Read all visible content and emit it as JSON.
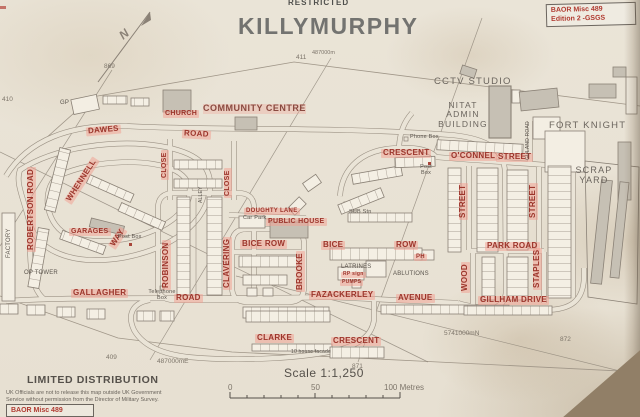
{
  "header": {
    "classification": "RESTRICTED",
    "title": "KILLYMURPHY"
  },
  "edition_box": {
    "line1": "BAOR Misc 489",
    "line2": "Edition 2 -GSGS"
  },
  "corner_box": {
    "text": "BAOR Misc 489"
  },
  "distribution": {
    "heading": "LIMITED DISTRIBUTION",
    "line1": "UK Officials are not to release this map outside UK Government",
    "line2": "Service without permission from the Director of Military Survey."
  },
  "scale": {
    "label": "Scale 1:1,250",
    "tick0": "0",
    "tick50": "50",
    "tick100": "100 Metres"
  },
  "grid": {
    "e869": "869",
    "n411": "411",
    "e870_top": "487000m",
    "n410": "410",
    "n409": "409",
    "e870_bottom": "487000mE",
    "e871": "871",
    "e872": "872",
    "n5741": "5741000mN"
  },
  "compass": {
    "label": "N"
  },
  "colors": {
    "red_label": "#9c352b",
    "highlight": "#f19d8f",
    "paper": "#eae4d7",
    "line": "#8a8176"
  },
  "labels": {
    "dawes": "DAWES",
    "dawes_road": "ROAD",
    "church": "CHURCH",
    "community_centre": "COMMUNITY CENTRE",
    "close_a": "CLOSE",
    "close_b": "CLOSE",
    "whennell": "WHENNELL",
    "robertson_road": "ROBERTSON ROAD",
    "garages": "GARAGES",
    "way": "WAY",
    "robinson": "ROBINSON",
    "clavering": "CLAVERING",
    "bice_row_a": "BICE ROW",
    "brooke": "BROOKE",
    "doughty_lane": "DOUGHTY LANE",
    "public_house": "PUBLIC HOUSE",
    "car_park": "Car Park",
    "bice_b": "BICE",
    "row_b": "ROW",
    "ph": "PH",
    "crescent_a": "CRESCENT",
    "oconnel": "O'CONNEL",
    "oconnel_street": "STREET",
    "street_a": "STREET",
    "street_b": "STREET",
    "park_road": "PARK ROAD",
    "staples": "STAPLES",
    "wood": "WOOD",
    "gillham_drive": "GILLHAM DRIVE",
    "fazackerley": "FAZACKERLEY",
    "avenue": "AVENUE",
    "gallagher": "GALLAGHER",
    "gallagher_road": "ROAD",
    "clarke": "CLARKE",
    "clarke_crescent": "CRESCENT",
    "rp_sign": "RP sign",
    "pumps": "PUMPS",
    "latrines": "LATRINES",
    "ablutions": "ABLUTIONS",
    "sub_stn": "SUB Stn",
    "post_box_a": "Post Box",
    "post_box_b": "Post Box",
    "phone_box": "Phone Box",
    "telephone_box": "Telephone Box",
    "op_tower": "OP TOWER",
    "factory": "FACTORY",
    "gp": "GP",
    "alley": "ALLEY",
    "guland_road": "GULAND ROAD",
    "cctv_studio": "CCTV STUDIO",
    "nitat_1": "NITAT",
    "nitat_2": "ADMIN",
    "nitat_3": "BUILDING",
    "fort_knight": "FORT KNIGHT",
    "scrap_1": "SCRAP",
    "scrap_2": "YARD",
    "ten_house_facade": "10 house facade"
  }
}
